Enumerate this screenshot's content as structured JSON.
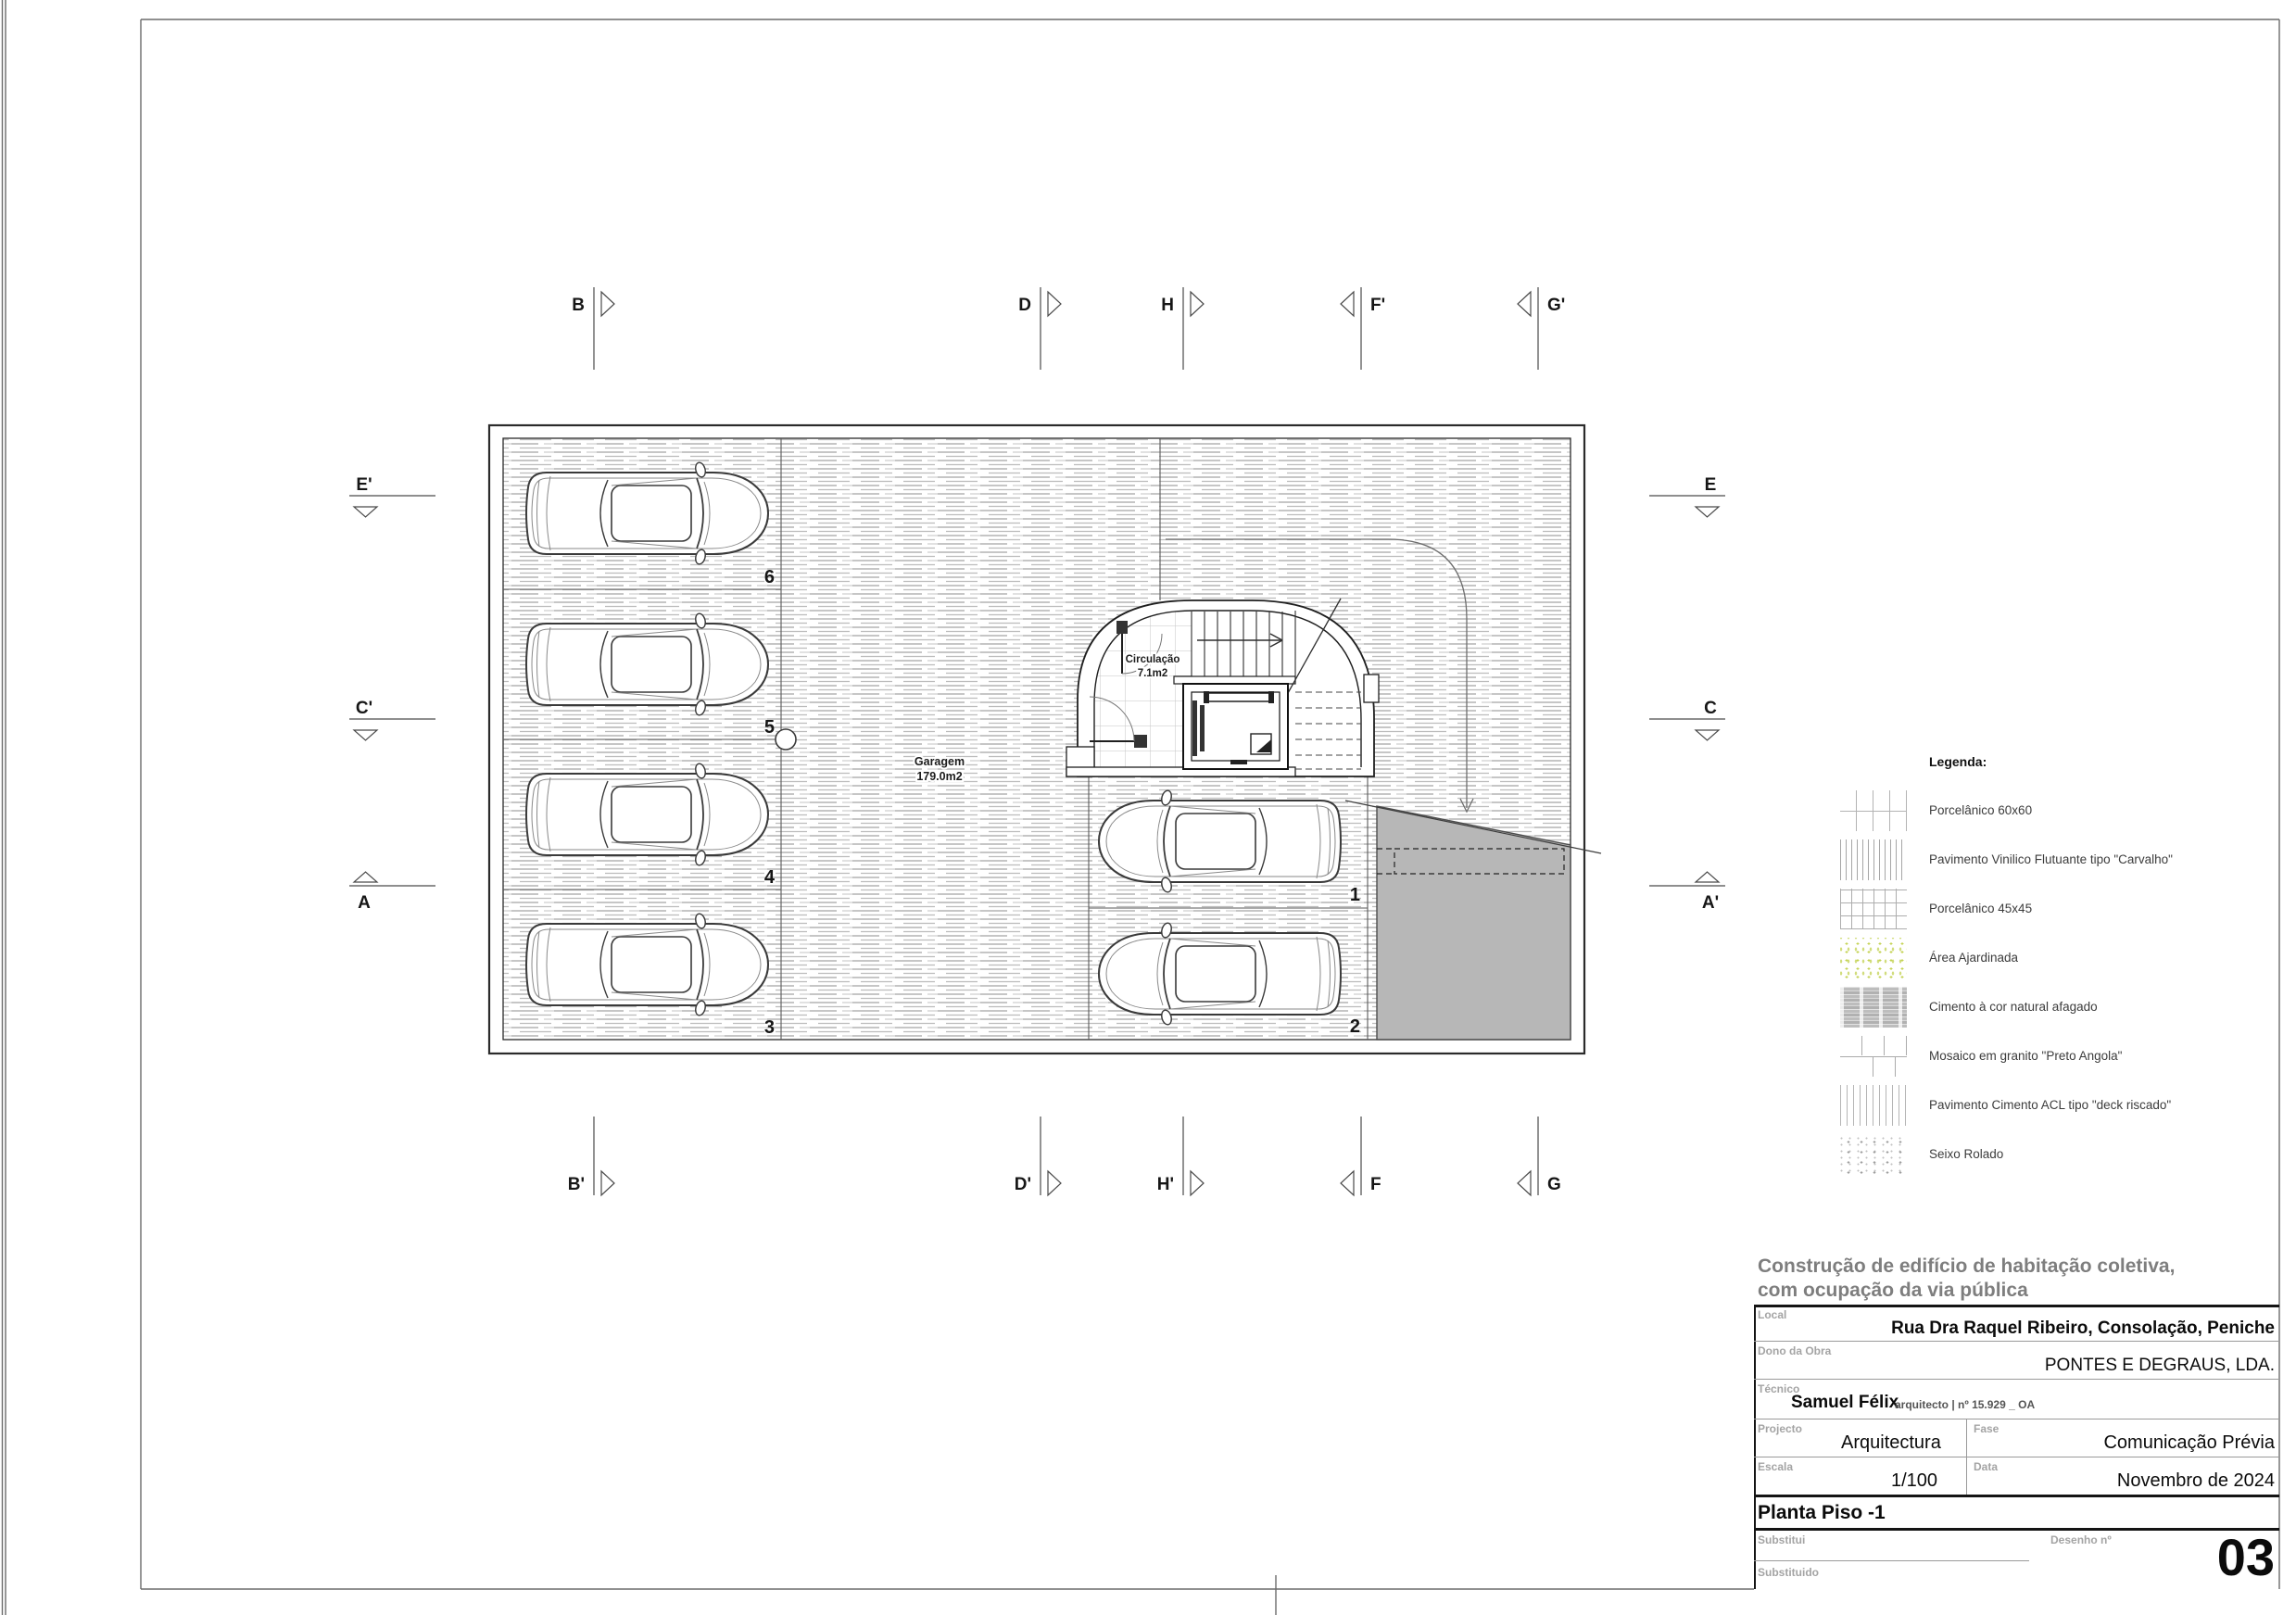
{
  "sheet": {
    "project_title_line1": "Construção de edifício de habitação coletiva,",
    "project_title_line2": "com ocupação da via pública",
    "local_label": "Local",
    "local_value": "Rua Dra Raquel Ribeiro, Consolação, Peniche",
    "dono_label": "Dono da Obra",
    "dono_value": "PONTES E DEGRAUS, LDA.",
    "tecnico_label": "Técnico",
    "tecnico_name": "Samuel Félix",
    "tecnico_suffix": "arquitecto | nº 15.929 _ OA",
    "projecto_label": "Projecto",
    "projecto_value": "Arquitectura",
    "fase_label": "Fase",
    "fase_value": "Comunicação Prévia",
    "escala_label": "Escala",
    "escala_value": "1/100",
    "data_label": "Data",
    "data_value": "Novembro de 2024",
    "drawing_title": "Planta Piso -1",
    "substitui_label": "Substitui",
    "substituido_label": "Substituido",
    "desenho_label": "Desenho nº",
    "desenho_value": "03"
  },
  "legend": {
    "title": "Legenda:",
    "items": [
      {
        "label": "Porcelânico 60x60",
        "pattern": "grid-60"
      },
      {
        "label": "Pavimento Vinilico Flutuante tipo \"Carvalho\"",
        "pattern": "vertical-dense"
      },
      {
        "label": "Porcelânico 45x45",
        "pattern": "grid-45"
      },
      {
        "label": "Área Ajardinada",
        "pattern": "green-dots"
      },
      {
        "label": "Cimento à cor natural afagado",
        "pattern": "gray-streaks"
      },
      {
        "label": "Mosaico em granito \"Preto Angola\"",
        "pattern": "running-bond"
      },
      {
        "label": "Pavimento Cimento ACL tipo \"deck riscado\"",
        "pattern": "vertical-lines"
      },
      {
        "label": "Seixo Rolado",
        "pattern": "gray-dots"
      }
    ]
  },
  "plan": {
    "garagem_name": "Garagem",
    "garagem_area": "179.0m2",
    "circulacao_name": "Circulação",
    "circulacao_area": "7.1m2",
    "stalls": [
      "6",
      "5",
      "4",
      "3",
      "1",
      "2"
    ]
  },
  "markers": {
    "top": [
      "B",
      "D",
      "H",
      "F'",
      "G'"
    ],
    "bottom": [
      "B'",
      "D'",
      "H'",
      "F",
      "G"
    ],
    "left": [
      "E'",
      "C'",
      "A"
    ],
    "right": [
      "E",
      "C",
      "A'"
    ]
  },
  "colors": {
    "ramp_gray": "#b7b7b7",
    "hatch_gray": "#b3b3b3",
    "garden_green": "#c4d354",
    "wall_line": "#2b2b2b",
    "title_gray": "#7e7e7e"
  }
}
